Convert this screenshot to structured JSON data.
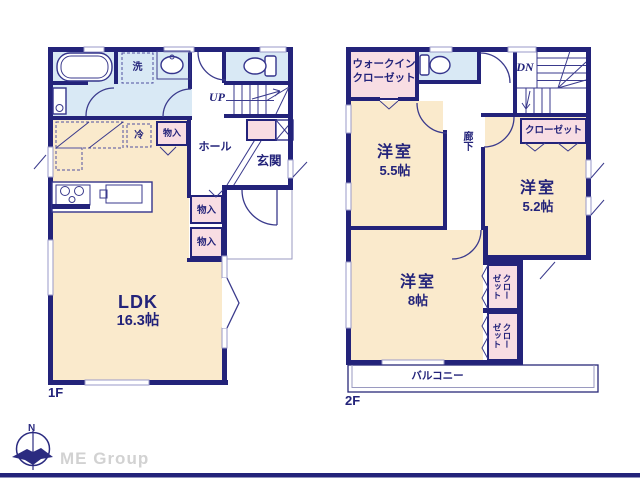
{
  "floor1": {
    "label": "1F",
    "ldk": {
      "name": "LDK",
      "size": "16.3帖"
    },
    "hall": "ホール",
    "entrance": "玄関",
    "stairs_direction": "UP",
    "laundry": "洗",
    "fridge": "冷",
    "storage_kitchen": "物入",
    "storage_hall_1": "物入",
    "storage_hall_2": "物入"
  },
  "floor2": {
    "label": "2F",
    "walk_in_closet_line1": "ウォークイン",
    "walk_in_closet_line2": "クローゼット",
    "bedroom_a": {
      "name": "洋室",
      "size": "5.5帖"
    },
    "bedroom_b": {
      "name": "洋室",
      "size": "5.2帖"
    },
    "bedroom_c": {
      "name": "洋室",
      "size": "8帖"
    },
    "closet_b": "クローゼット",
    "closet_c1": "クローゼット",
    "closet_c2": "クローゼット",
    "corridor": "廊下",
    "stairs_direction": "DN",
    "balcony": "バルコニー"
  },
  "footer": {
    "compass_north": "N",
    "company": "ME Group"
  },
  "colors": {
    "wall": "#23237A",
    "room": "#FAEACC",
    "wet_area": "#D9E9F5",
    "closet": "#F8DDE3",
    "line": "#3A3A8C",
    "logo_text": "#D2D2D2"
  }
}
